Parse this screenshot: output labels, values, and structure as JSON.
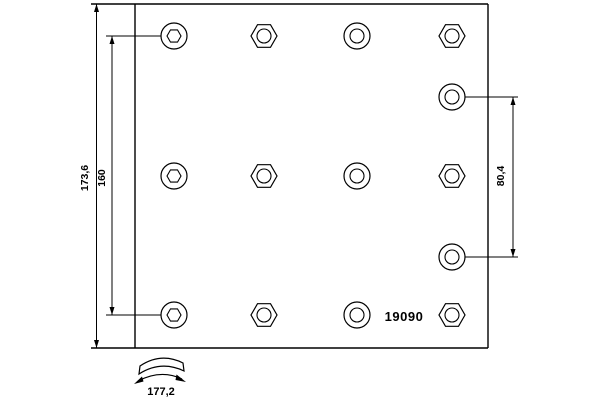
{
  "drawing": {
    "type": "brake-lining-technical-drawing",
    "part_number": "19090",
    "labels": {
      "total_height": "173,6",
      "left_hole_spacing": "160",
      "right_hole_spacing": "80,4",
      "arc_width": "177,2"
    },
    "colors": {
      "line": "#000000",
      "background": "#ffffff",
      "text": "#000000"
    },
    "plate": {
      "x": 135,
      "y": 4,
      "width": 353,
      "height": 344
    },
    "hole_radii": {
      "outer": 13,
      "inner": 7
    },
    "holes": [
      {
        "cx": 174,
        "cy": 36,
        "outer": "circle",
        "inner": "hex"
      },
      {
        "cx": 264,
        "cy": 36,
        "outer": "hex",
        "inner": "circle"
      },
      {
        "cx": 357,
        "cy": 36,
        "outer": "circle",
        "inner": "circle"
      },
      {
        "cx": 452,
        "cy": 36,
        "outer": "hex",
        "inner": "circle"
      },
      {
        "cx": 452,
        "cy": 97,
        "outer": "circle",
        "inner": "circle"
      },
      {
        "cx": 174,
        "cy": 176,
        "outer": "circle",
        "inner": "hex"
      },
      {
        "cx": 264,
        "cy": 176,
        "outer": "hex",
        "inner": "circle"
      },
      {
        "cx": 357,
        "cy": 176,
        "outer": "circle",
        "inner": "circle"
      },
      {
        "cx": 452,
        "cy": 176,
        "outer": "hex",
        "inner": "circle"
      },
      {
        "cx": 452,
        "cy": 257,
        "outer": "circle",
        "inner": "circle"
      },
      {
        "cx": 174,
        "cy": 315,
        "outer": "circle",
        "inner": "hex"
      },
      {
        "cx": 264,
        "cy": 315,
        "outer": "hex",
        "inner": "circle"
      },
      {
        "cx": 357,
        "cy": 315,
        "outer": "circle",
        "inner": "circle"
      },
      {
        "cx": 452,
        "cy": 315,
        "outer": "hex",
        "inner": "circle"
      }
    ]
  }
}
